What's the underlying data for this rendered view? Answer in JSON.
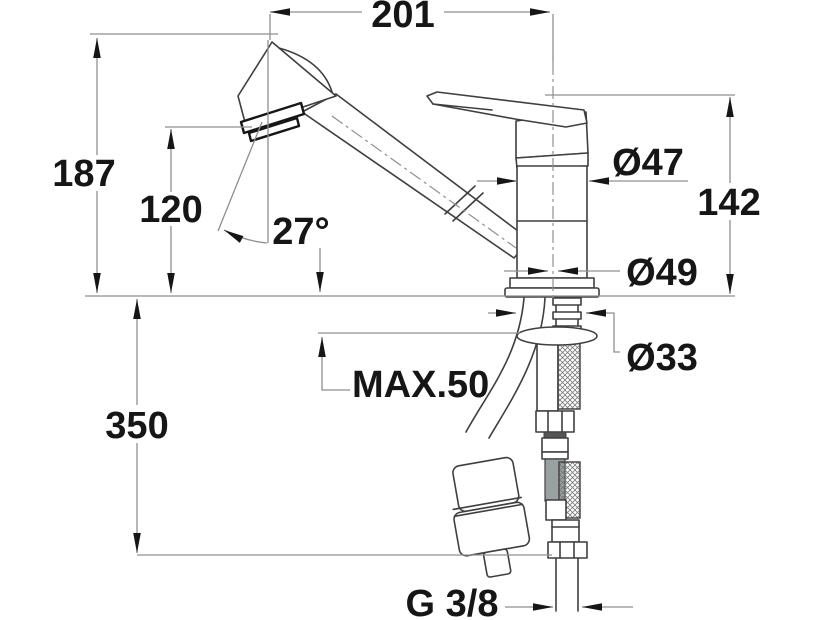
{
  "drawing": {
    "type": "technical-dimension-drawing",
    "subject": "Single-lever kitchen mixer tap with pull-out spray head, side view with installation dimensions",
    "background": "#ffffff",
    "outline_color": "#3f3f3f",
    "dimension_line_color": "#8f8f8f",
    "text_color": "#161616"
  },
  "dimensions": {
    "spout_reach": "201",
    "overall_height": "187",
    "spout_outlet_height": "120",
    "spout_angle": "27°",
    "body_height": "142",
    "body_diameter": "Ø47",
    "base_diameter": "Ø49",
    "shank_diameter": "Ø33",
    "hose_drop": "350",
    "max_counter_thickness": "MAX.50",
    "connection_thread": "G 3/8"
  }
}
